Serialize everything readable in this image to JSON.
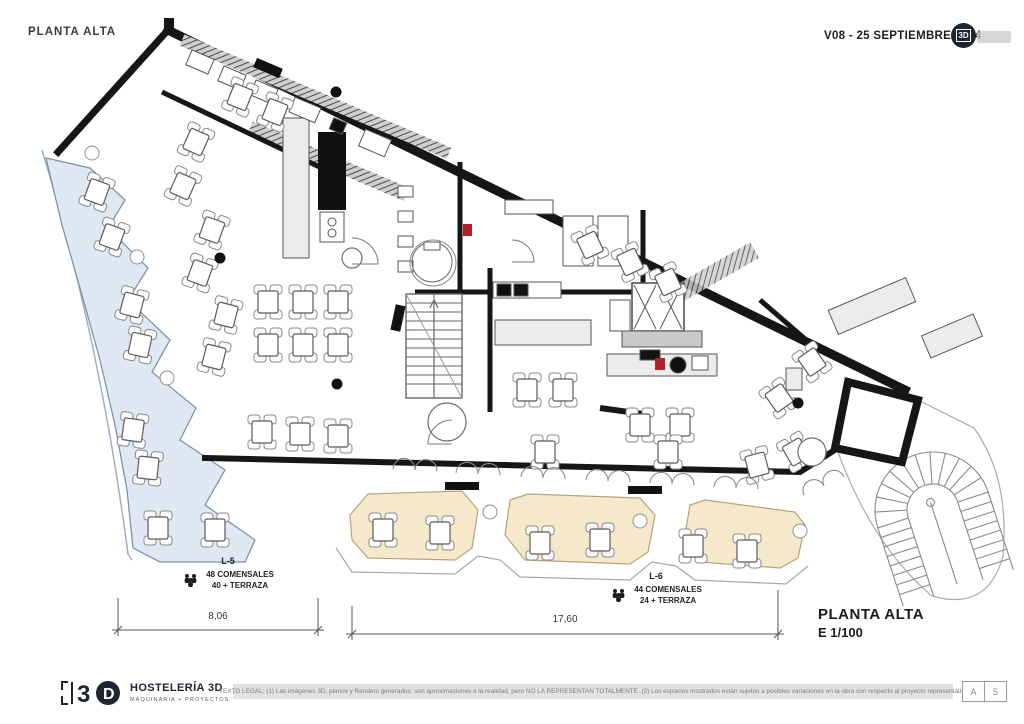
{
  "header": {
    "title": "PLANTA ALTA",
    "version": "V08 - 25 SEPTIEMBRE 2024",
    "logo_mark": "3D"
  },
  "plan": {
    "zones": {
      "l5": {
        "code": "L-5",
        "seats": "48 COMENSALES",
        "terrace": "40 + TERRAZA"
      },
      "l6": {
        "code": "L-6",
        "seats": "44 COMENSALES",
        "terrace": "24 + TERRAZA"
      }
    },
    "dimensions": {
      "left": "8,06",
      "bottom": "17,60"
    },
    "titleblock": {
      "name": "PLANTA ALTA",
      "scale": "E 1/100"
    },
    "colors": {
      "terrace_blue": "#dfe9f4",
      "terrace_beige": "#f6e8cb",
      "wall": "#161616",
      "accent_red": "#b3202a"
    }
  },
  "footer": {
    "brand": {
      "name": "HOSTELERÍA 3D",
      "tagline": "MAQUINARIA + PROYECTOS",
      "mark_number": "3",
      "mark_letter": "D"
    },
    "legal": "TEXTO LEGAL:  (1) Las imágenes 3D, planos y Renders generados: son aproximaciones a la realidad, pero NO LA REPRESENTAN TOTALMENTE. (2) Los espacios mostrados están sujetos a posibles variaciones en la obra con respecto al proyecto representado.",
    "page": {
      "letter": "A",
      "number": "5"
    }
  }
}
